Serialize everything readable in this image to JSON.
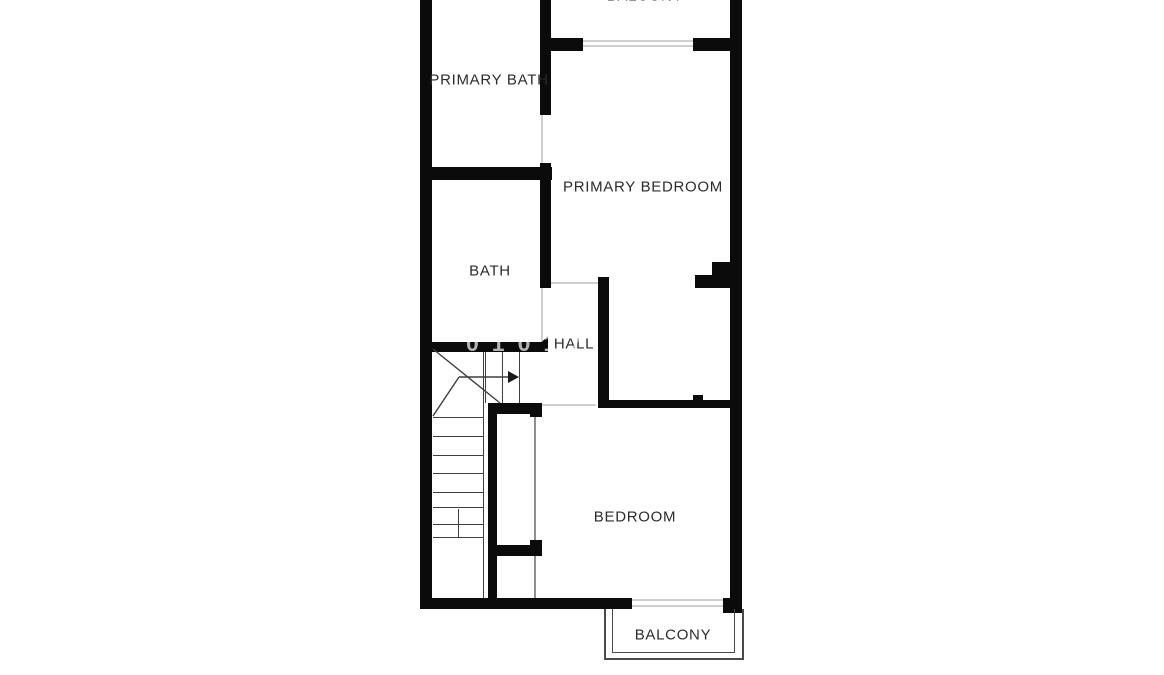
{
  "document": {
    "type": "floor-plan",
    "view": "upper floor (top edge of plan cropped)"
  },
  "rooms": {
    "primary_bath": {
      "label": "PRIMARY BATH"
    },
    "primary_bedroom": {
      "label": "PRIMARY BEDROOM"
    },
    "bath": {
      "label": "BATH"
    },
    "hall": {
      "label": "HALL"
    },
    "bedroom": {
      "label": "BEDROOM"
    },
    "balcony_top": {
      "label": "BALCONY"
    },
    "balcony_bottom": {
      "label": "BALCONY"
    }
  },
  "stairs": {
    "tread_lines": 8,
    "up_arrow_direction": "right"
  },
  "watermark": {
    "text": "01017"
  },
  "colors": {
    "background": "#ffffff",
    "wall": "#0b0b0b",
    "label_text": "#2b2b2b",
    "stair_line": "#3f3f3f",
    "opening_line": "#cfcfcf",
    "balcony_outline": "#4a4a4a",
    "watermark": "#b3b3b3"
  }
}
